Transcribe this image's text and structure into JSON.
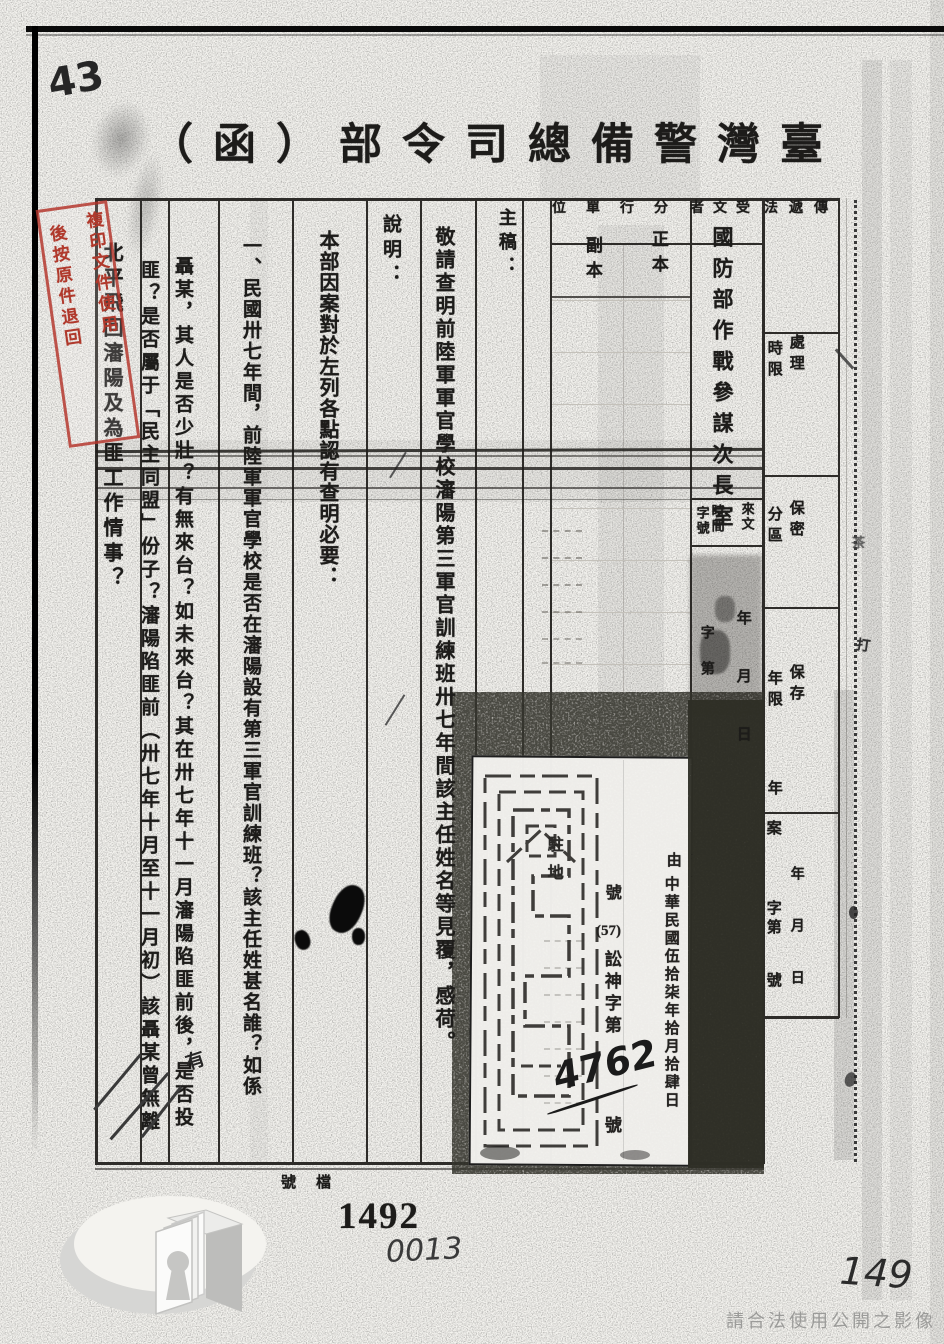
{
  "document": {
    "title": "臺灣警備總司令部（函）",
    "title_display": "（函）部令司總備警灣臺"
  },
  "annotations": {
    "top_left_number": "43",
    "inserted_word": "有",
    "margin_mark_hit": "打",
    "margin_mark_tea": "茶",
    "archive_label": "檔號",
    "archive_stamp_number": "1492",
    "archive_written_number": "0013",
    "page_number_written": "149",
    "watermark": "請合法使用公開之影像"
  },
  "red_stamp": {
    "col_right": "複印文件使用",
    "col_left": "後按原件退回",
    "color": "#b0392c"
  },
  "form": {
    "recipient_label": "受文者",
    "recipient": "國防部作戰參謀次長室",
    "distribution_label": "分行單位",
    "original_label": "正本",
    "copy_label": "副本",
    "drafter_label": "主稿：",
    "subject": "敬請查明前陸軍軍官學校瀋陽第三軍官訓練班卅七年間該主任姓名等見覆，感荷。",
    "explanation_label": "說明：",
    "explanation": [
      "本部因案對於左列各點認有查明必要：",
      "一、民國卅七年間，前陸軍軍官學校是否在瀋陽設有第三軍官訓練班？該主任姓甚名誰？如係",
      "聶某，其人是否少壯？有無來台？如未來台？其在卅七年十一月瀋陽陷匪前後，是否投",
      "匪？是否屬于「民主同盟」份子？瀋陽陷匪前（卅七年十月至十一月初）該聶某曾無離",
      "北平飛回瀋陽及為匪工作情事？"
    ],
    "incoming": {
      "label": "來文",
      "time_label": "時間",
      "number_label": "字號",
      "time_fields": "年　月　日",
      "number_fields": "字　第"
    },
    "right_strip": {
      "delivery_label": "傳遞法",
      "processing_right": "處理",
      "processing_left": "時限",
      "security_right": "保密",
      "security_left": "分區",
      "retention_right": "保存",
      "retention_left": "年限",
      "retention_year": "年",
      "file_case": "案",
      "file_char_no": "字第",
      "file_no": "號",
      "file_date": "年　月　日"
    }
  },
  "receipt_stamp": {
    "station": "駐地",
    "ref_prefix": "號",
    "ref_year": "(57)",
    "ref_code": "訟神字第",
    "ref_number": "4762",
    "ref_suffix": "號",
    "by_label": "由",
    "date": "中華民國伍拾柒年拾月拾肆日"
  }
}
